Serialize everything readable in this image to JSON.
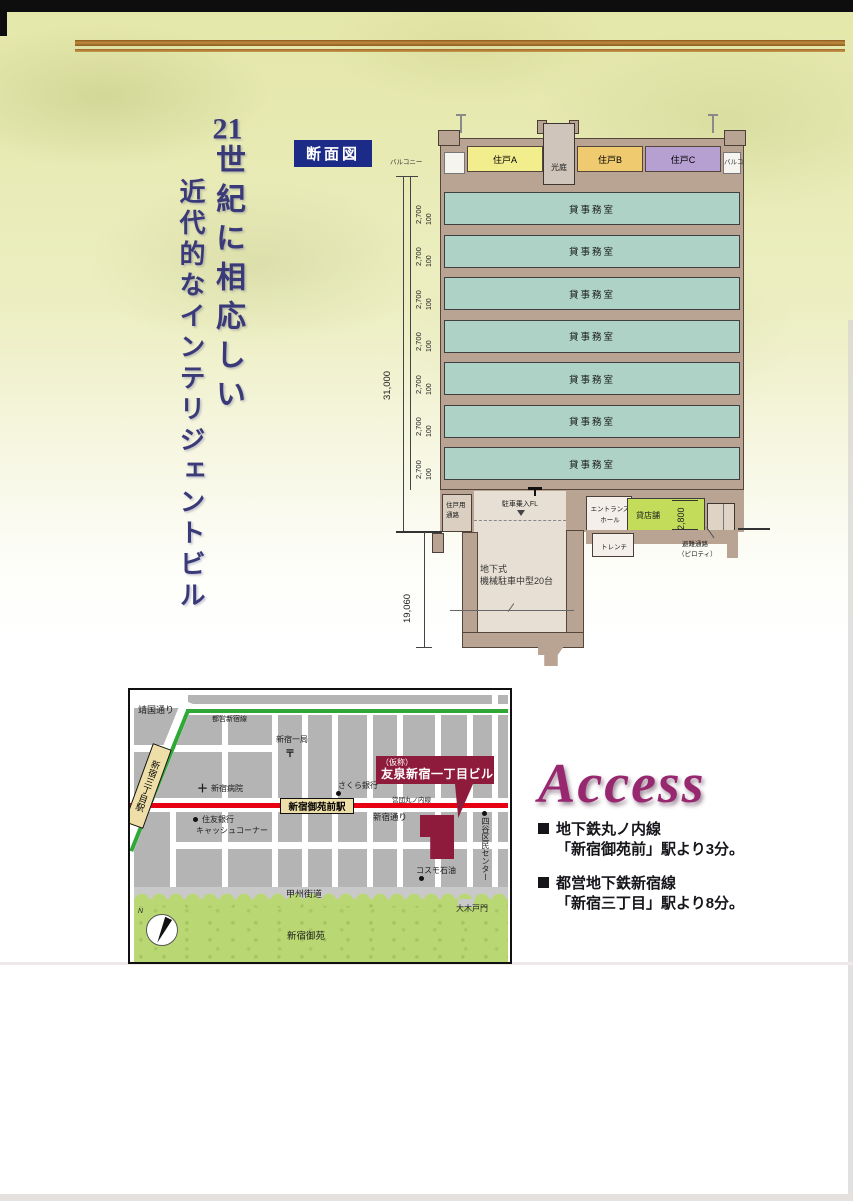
{
  "page": {
    "section_label": "断面図",
    "vertical_title": {
      "number": "21",
      "tail": "世紀に相応しい",
      "line2": "近代的なインテリジェントビル"
    }
  },
  "cross_section": {
    "roof": {
      "balcony_left": "バルコニー",
      "unit_a": "住戸A",
      "light_court": "光庭",
      "unit_b": "住戸B",
      "unit_c": "住戸C",
      "balcony_right": "バルコニー"
    },
    "office_floors": [
      "貸事務室",
      "貸事務室",
      "貸事務室",
      "貸事務室",
      "貸事務室",
      "貸事務室",
      "貸事務室"
    ],
    "dims": {
      "total": "31,000",
      "floor": "2,700",
      "slab": "100",
      "basement": "19,060",
      "shop": "2,800"
    },
    "ground": {
      "unit_corridor_1": "住戸用",
      "unit_corridor_2": "通路",
      "parking_entry": "駐車乗入FL",
      "entrance_1": "エントランス",
      "entrance_2": "ホール",
      "trench": "トレンチ",
      "shop": "貸店舗",
      "escape_1": "避難通路",
      "escape_2": "（ピロティ）"
    },
    "basement": {
      "line1": "地下式",
      "line2": "機械駐車中型20台"
    }
  },
  "map": {
    "roads": {
      "yasukuni": "靖国通り",
      "shinjuku_dori": "新宿通り",
      "koshu": "甲州街道"
    },
    "rail": {
      "toei_shinjuku": "都営新宿線",
      "marunouchi": "営団丸ノ内線"
    },
    "stations": {
      "sanchome": "新宿三丁目駅",
      "gyoemmae": "新宿御苑前駅"
    },
    "building": {
      "prefix": "（仮称）",
      "name": "友泉新宿一丁目ビル"
    },
    "landmarks": {
      "post_office": "新宿一局",
      "post_symbol": "〒",
      "hospital_mark": "＋",
      "hospital": "新宿病院",
      "sakura_bank": "さくら銀行",
      "sumitomo_bank": "住友銀行",
      "cash_corner": "キャッシュコーナー",
      "cosmo": "コスモ石油",
      "yotsuya_center": "四谷区民センター",
      "okido_gate": "大木戸門",
      "gyoen": "新宿御苑"
    },
    "compass_n": "N"
  },
  "access": {
    "heading": "Access",
    "items": [
      {
        "line1": "地下鉄丸ノ内線",
        "line2": "「新宿御苑前」駅より3分。"
      },
      {
        "line1": "都営地下鉄新宿線",
        "line2": "「新宿三丁目」駅より8分。"
      }
    ]
  },
  "colors": {
    "accent_navy": "#1c2b87",
    "brand_maroon": "#8e1b3c",
    "access_magenta": "#97286f",
    "rail_red": "#e60012",
    "rail_green": "#2fa838"
  }
}
